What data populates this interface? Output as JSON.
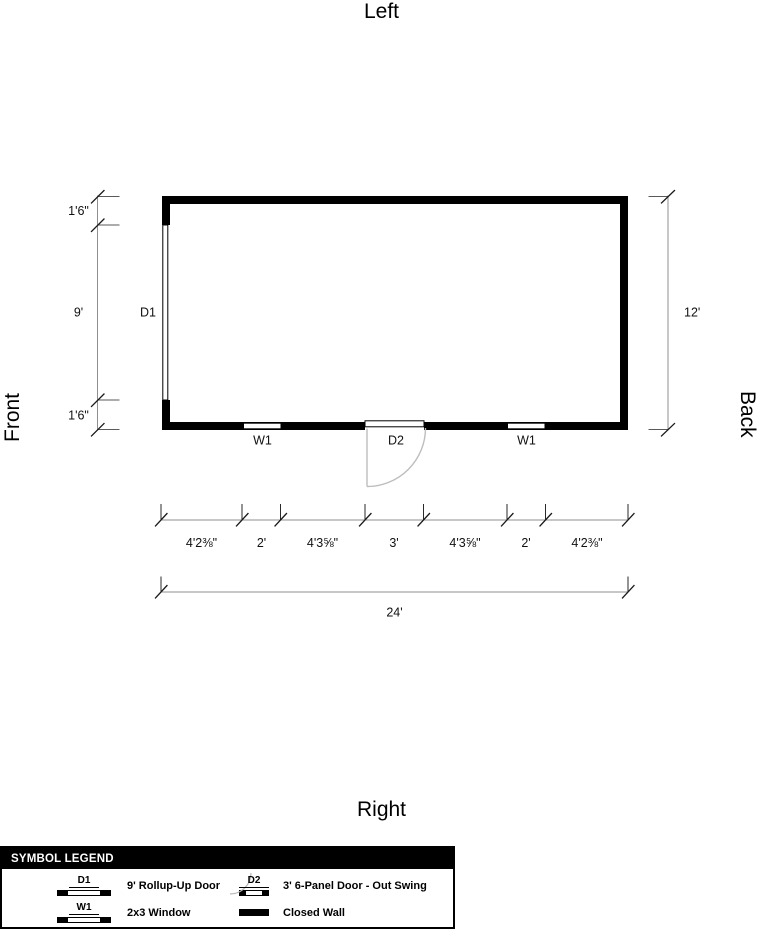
{
  "orientation": {
    "top": "Left",
    "left": "Front",
    "right": "Back",
    "bottom": "Right"
  },
  "plan_labels": {
    "d1": "D1",
    "d2": "D2",
    "w1": "W1"
  },
  "dimensions": {
    "left_top": "1'6\"",
    "left_middle": "9'",
    "left_bottom": "1'6\"",
    "right_total": "12'",
    "bottom_segments": [
      "4'2⅜\"",
      "2'",
      "4'3⅝\"",
      "3'",
      "4'3⅝\"",
      "2'",
      "4'2⅜\""
    ],
    "bottom_total": "24'"
  },
  "legend": {
    "title": "SYMBOL LEGEND",
    "items": [
      {
        "symbol": "D1",
        "label": "9' Rollup-Up Door"
      },
      {
        "symbol": "D2",
        "label": "3' 6-Panel Door - Out Swing"
      },
      {
        "symbol": "W1",
        "label": "2x3 Window"
      },
      {
        "symbol": "",
        "label": "Closed Wall"
      }
    ]
  },
  "colors": {
    "wall": "#000000",
    "door_swing": "#bdbdbd",
    "dimension_line": "#8f8f8f",
    "legend_header_bg": "#000000",
    "legend_header_text": "#ffffff"
  }
}
